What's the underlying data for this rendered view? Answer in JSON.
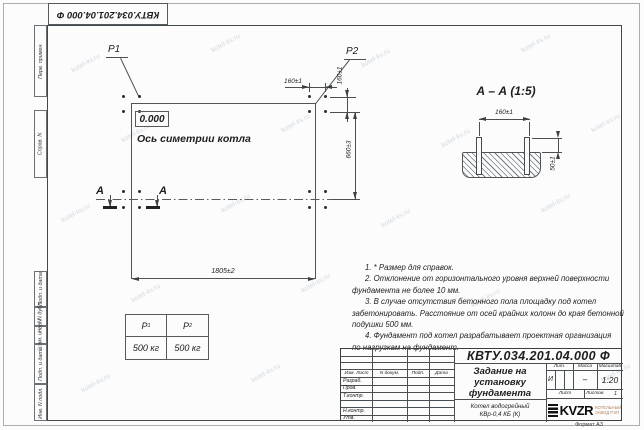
{
  "doc_number": "КВТУ.034.201.04.000 Ф",
  "watermark": "kotel-kv.ru",
  "margin_labels": [
    "Перв. примен.",
    "Справ. N",
    "Подп. и дата",
    "Инв. N дубл.",
    "Взам. инв. N",
    "Подп. и дата",
    "Инв. N подл."
  ],
  "plan": {
    "load_p1": "P1",
    "load_p2": "P2",
    "zero_level": "0.000",
    "axis_label": "Ось симетрии котла",
    "section_letter": "А",
    "dim_width": "1805±2",
    "dim_height": "660±3",
    "dim_bolt_h": "160±1",
    "dim_bolt_v": "160±1"
  },
  "section": {
    "title": "А – А (1:5)",
    "dim_bolts": "160±1",
    "dim_protrusion": "50±1"
  },
  "load_table": {
    "headers": [
      {
        "label": "P",
        "sub": "1"
      },
      {
        "label": "P",
        "sub": "2"
      }
    ],
    "values": [
      "500 кг",
      "500 кг"
    ]
  },
  "notes": {
    "lines": [
      "1. * Размер для справок.",
      "2. Отклонение от горизонтального уровня верхней поверхности",
      "фундамента не более 10 мм.",
      "3. В случае отсутствия бетонного пола площадку под котел",
      "забетонировать. Расстояние от осей крайних колонн до края бетонной",
      "подушки 500 мм.",
      "4. Фундамент под котел разрабатывает проектная организация",
      "по нагрузкам на фундамент."
    ]
  },
  "title_block": {
    "title_lines": [
      "Задание на",
      "установку",
      "фундамента"
    ],
    "product_lines": [
      "Котел водогрейный",
      "КВр-0,4 КБ (К)"
    ],
    "header_cols": [
      "Изм. Лист",
      "N докум.",
      "Подп.",
      "Дата"
    ],
    "row_labels": [
      "Разраб.",
      "Пров.",
      "Т.контр.",
      "",
      "Н.контр.",
      "Утв."
    ],
    "lit_label": "Лит.",
    "mass_label": "Масса",
    "scale_label": "Масштаб",
    "lit_value": "И",
    "mass_value": "–",
    "scale_value": "1:20",
    "sheet_label": "Лист",
    "sheets_label": "Листов",
    "sheets_value": "1",
    "logo_text": "KVZR",
    "logo_caption_lines": [
      "КОТЕЛЬНЫЙ",
      "ЗАВОД РЭП"
    ],
    "format_label": "Формат А3"
  }
}
